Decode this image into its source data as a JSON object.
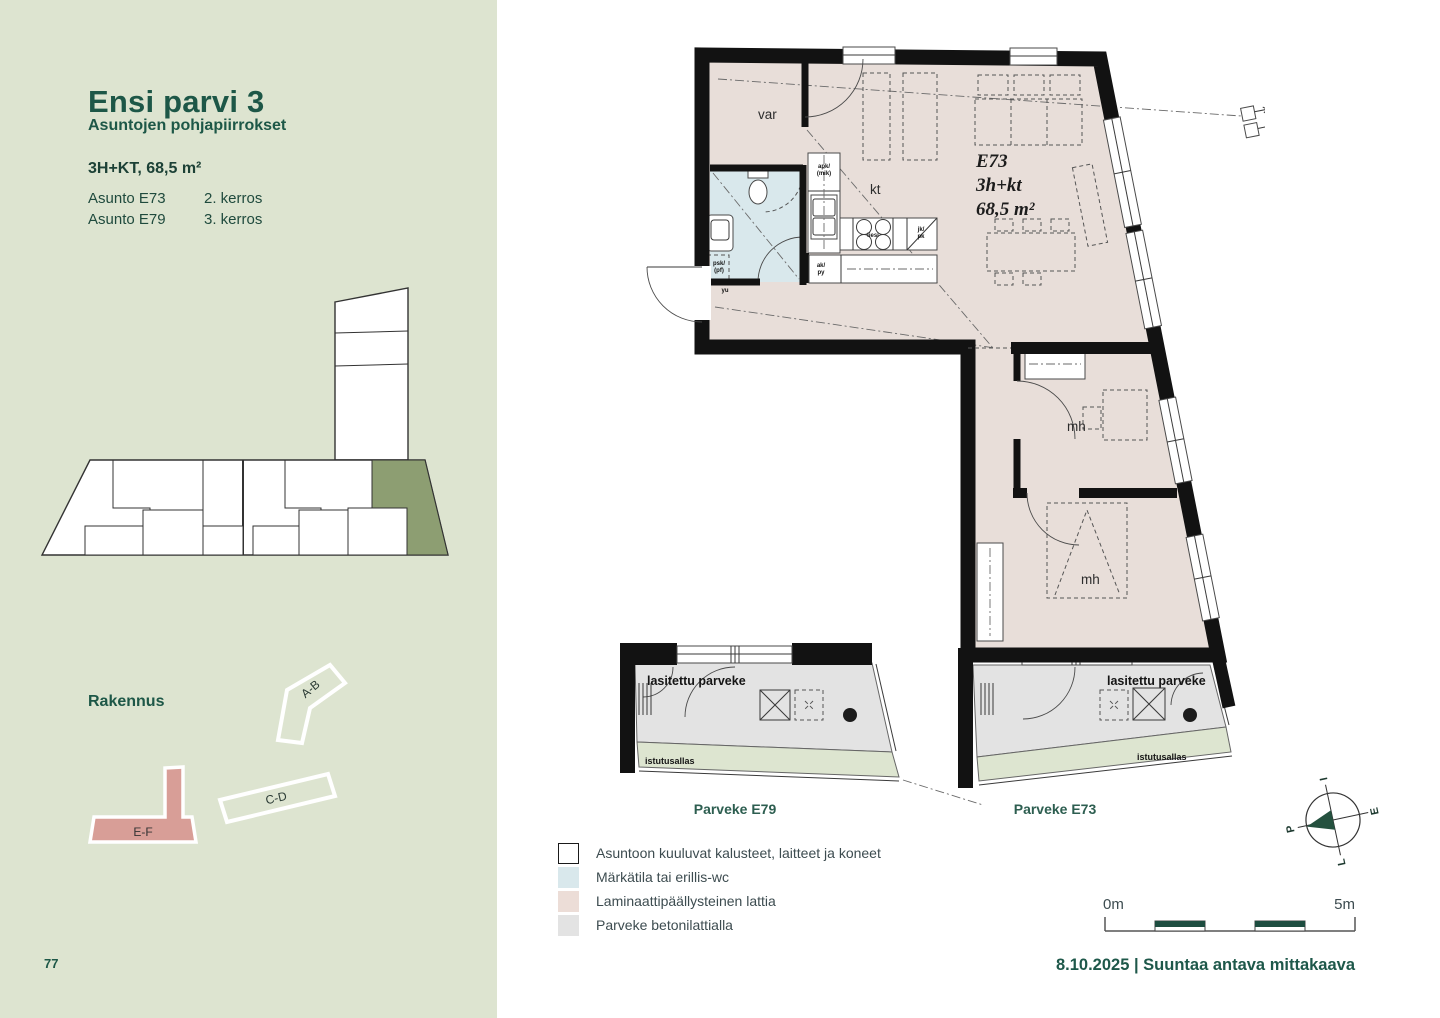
{
  "page": {
    "number": "77"
  },
  "sidebar": {
    "title": "Ensi parvi 3",
    "subtitle": "Asuntojen pohjapiirrokset",
    "apartment_type": "3H+KT, 68,5 m²",
    "units": [
      {
        "name": "Asunto E73",
        "floor": "2. kerros"
      },
      {
        "name": "Asunto E79",
        "floor": "3. kerros"
      }
    ],
    "building_section_label": "Rakennus",
    "building_shapes": {
      "ab": "A-B",
      "cd": "C-D",
      "ef": "E-F"
    },
    "colors": {
      "background": "#dde4d0",
      "highlight_unit": "#8d9e72",
      "highlight_building": "#d89e97",
      "heading": "#1d5747"
    }
  },
  "plan": {
    "unit": {
      "id": "E73",
      "type": "3h+kt",
      "area": "68,5 m²"
    },
    "rooms": {
      "storage": "var",
      "kitchen": "kt",
      "bedroom1": "mh",
      "bedroom2": "mh"
    },
    "fixtures": {
      "dishwasher1": "apk/",
      "dishwasher2": "(mik)",
      "stove": "liesi",
      "fridge1": "jk/",
      "fridge2": "pk",
      "cabinet1": "ak/",
      "cabinet2": "py",
      "washer1": "psk/",
      "washer2": "(pf)",
      "entry": "yu"
    },
    "balcony_left": {
      "label": "lasitettu parveke",
      "planter": "istutusallas",
      "caption": "Parveke E79"
    },
    "balcony_right": {
      "label": "lasitettu parveke",
      "planter": "istutusallas",
      "caption": "Parveke E73"
    },
    "floor_colors": {
      "laminate": "#e8ded9",
      "wet_room": "#d9e8ec",
      "balcony": "#e3e3e3",
      "planter": "#dde5d0"
    }
  },
  "legend": {
    "items": [
      {
        "label": "Asuntoon kuuluvat kalusteet, laitteet ja koneet",
        "color": "#ffffff"
      },
      {
        "label": "Märkätila tai erillis-wc",
        "color": "#d9e8ec"
      },
      {
        "label": "Laminaattipäällysteinen lattia",
        "color": "#ecddd7"
      },
      {
        "label": "Parveke betonilattialla",
        "color": "#e3e3e3"
      }
    ]
  },
  "compass": {
    "top": "I",
    "right": "E",
    "bottom": "L",
    "left": "P"
  },
  "scale_bar": {
    "start_label": "0m",
    "end_label": "5m"
  },
  "footer": {
    "caption": "8.10.2025 | Suuntaa antava mittakaava"
  }
}
